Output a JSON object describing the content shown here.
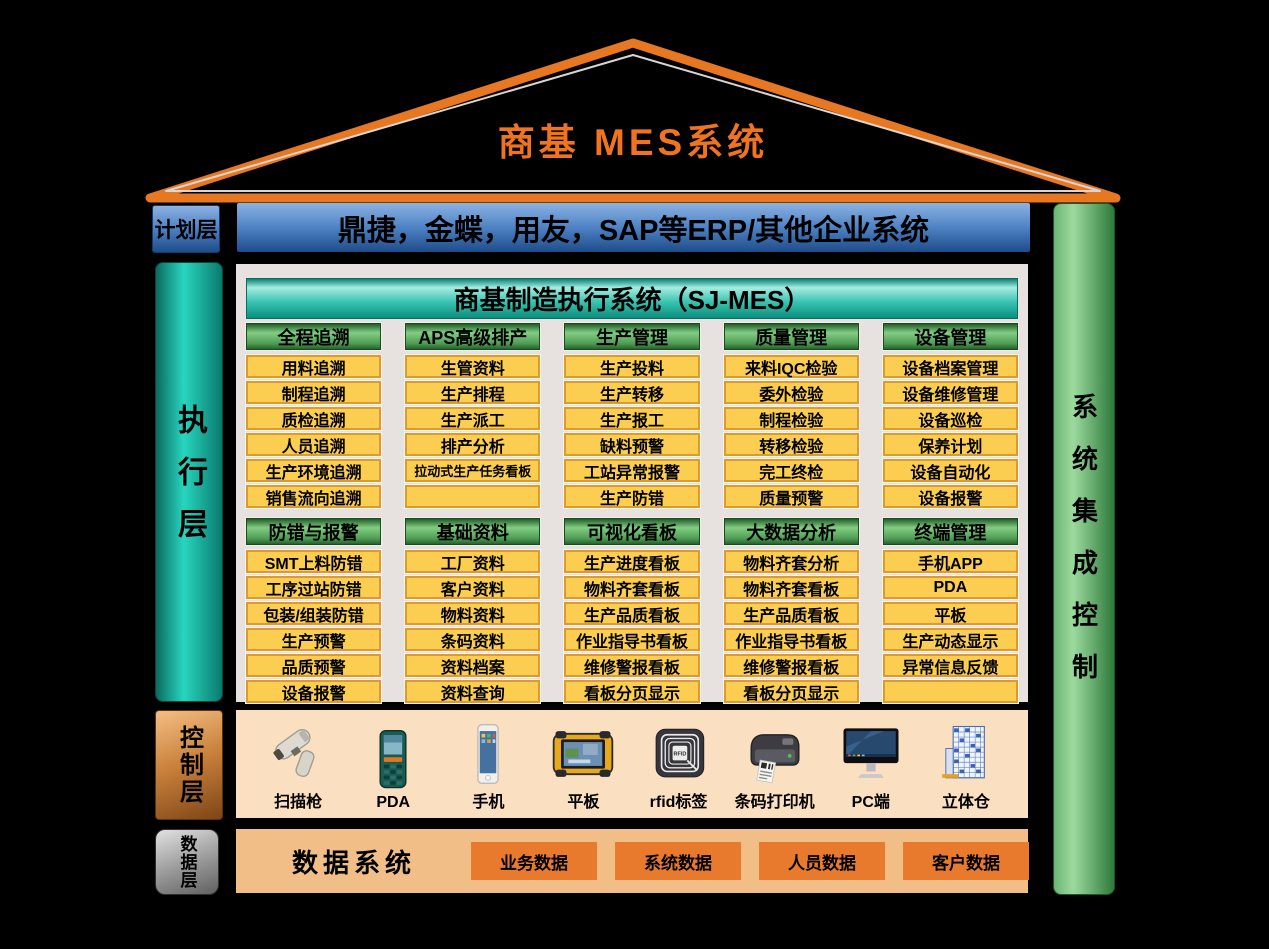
{
  "title": "商基  MES系统",
  "colors": {
    "roof_orange": "#E87722",
    "title_orange": "#F07320",
    "erp_blue": "#4E82C4",
    "execution_teal": "#27D6BF",
    "mes_header_teal": "#37C2AF",
    "group_header_green": "#4E9C54",
    "item_yellow": "#FBCE52",
    "item_border": "#DE9B2D",
    "panel_gray": "#E7E2E0",
    "right_bar_green": "#6CB573",
    "control_copper": "#C8803A",
    "data_layer_gray": "#9E9E9E",
    "control_bar_bg": "#FAE0C0",
    "data_bar_bg": "#F2BE87",
    "data_box_orange": "#E87A2E"
  },
  "left_labels": {
    "planning": "计划层",
    "execution": "执行层",
    "control": "控制层",
    "data": "数据层"
  },
  "erp_bar": "鼎捷，金蝶，用友，SAP等ERP/其他企业系统",
  "right_bar": "系统集成控制",
  "mes_panel": {
    "header": "商基制造执行系统（SJ-MES）",
    "groups_row1": [
      {
        "title": "全程追溯",
        "items": [
          "用料追溯",
          "制程追溯",
          "质检追溯",
          "人员追溯",
          "生产环境追溯",
          "销售流向追溯"
        ]
      },
      {
        "title": "APS高级排产",
        "items": [
          "生管资料",
          "生产排程",
          "生产派工",
          "排产分析",
          "拉动式生产任务看板",
          ""
        ]
      },
      {
        "title": "生产管理",
        "items": [
          "生产投料",
          "生产转移",
          "生产报工",
          "缺料预警",
          "工站异常报警",
          "生产防错"
        ]
      },
      {
        "title": "质量管理",
        "items": [
          "来料IQC检验",
          "委外检验",
          "制程检验",
          "转移检验",
          "完工终检",
          "质量预警"
        ]
      },
      {
        "title": "设备管理",
        "items": [
          "设备档案管理",
          "设备维修管理",
          "设备巡检",
          "保养计划",
          "设备自动化",
          "设备报警"
        ]
      }
    ],
    "groups_row2": [
      {
        "title": "防错与报警",
        "items": [
          "SMT上料防错",
          "工序过站防错",
          "包装/组装防错",
          "生产预警",
          "品质预警",
          "设备报警"
        ]
      },
      {
        "title": "基础资料",
        "items": [
          "工厂资料",
          "客户资料",
          "物料资料",
          "条码资料",
          "资料档案",
          "资料查询"
        ]
      },
      {
        "title": "可视化看板",
        "items": [
          "生产进度看板",
          "物料齐套看板",
          "生产品质看板",
          "作业指导书看板",
          "维修警报看板",
          "看板分页显示"
        ]
      },
      {
        "title": "大数据分析",
        "items": [
          "物料齐套分析",
          "物料齐套看板",
          "生产品质看板",
          "作业指导书看板",
          "维修警报看板",
          "看板分页显示"
        ]
      },
      {
        "title": "终端管理",
        "items": [
          "手机APP",
          "PDA",
          "平板",
          "生产动态显示",
          "异常信息反馈",
          ""
        ]
      }
    ]
  },
  "control_bar": {
    "rfid_chip_text": "RFID",
    "devices": [
      {
        "label": "扫描枪",
        "icon": "barcode-scanner-icon"
      },
      {
        "label": "PDA",
        "icon": "pda-icon"
      },
      {
        "label": "手机",
        "icon": "smartphone-icon"
      },
      {
        "label": "平板",
        "icon": "rugged-tablet-icon"
      },
      {
        "label": "rfid标签",
        "icon": "rfid-tag-icon"
      },
      {
        "label": "条码打印机",
        "icon": "barcode-printer-icon"
      },
      {
        "label": "PC端",
        "icon": "pc-monitor-icon"
      },
      {
        "label": "立体仓",
        "icon": "stereo-warehouse-icon"
      }
    ]
  },
  "data_bar": {
    "title": "数据系统",
    "boxes": [
      "业务数据",
      "系统数据",
      "人员数据",
      "客户数据"
    ]
  }
}
